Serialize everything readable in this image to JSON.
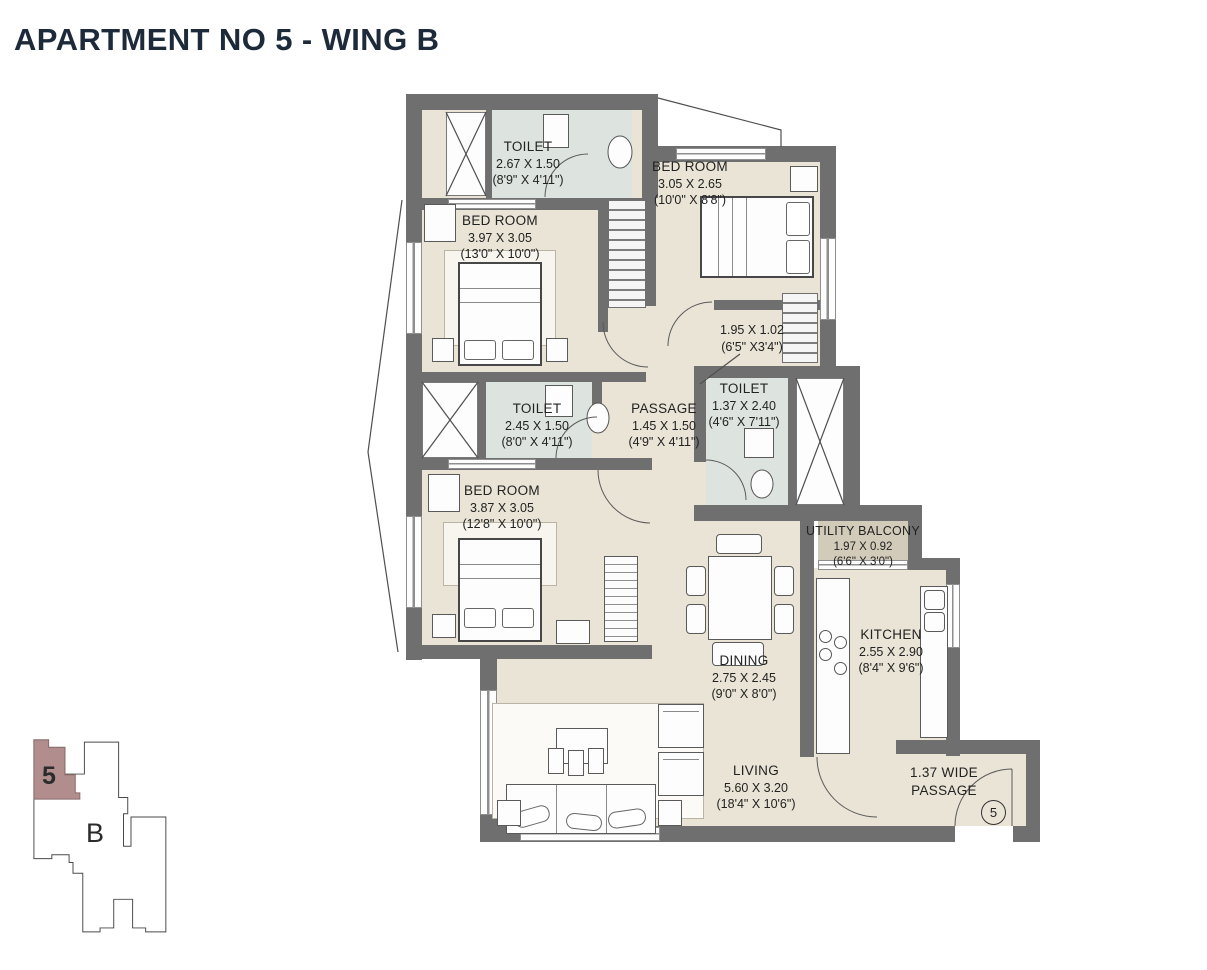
{
  "title": "APARTMENT NO 5 - WING B",
  "rooms": {
    "toilet_top": {
      "name": "TOILET",
      "dim_m": "2.67 X 1.50",
      "dim_ft": "(8'9\" X 4'11\")"
    },
    "bedroom_top_right": {
      "name": "BED ROOM",
      "dim_m": "3.05 X 2.65",
      "dim_ft": "(10'0\" X 8'8\")"
    },
    "bedroom_left": {
      "name": "BED ROOM",
      "dim_m": "3.97 X 3.05",
      "dim_ft": "(13'0\" X 10'0\")"
    },
    "lobby": {
      "dim_m": "1.95 X 1.02",
      "dim_ft": "(6'5\" X3'4\")"
    },
    "passage": {
      "name": "PASSAGE",
      "dim_m": "1.45 X 1.50",
      "dim_ft": "(4'9\" X 4'11\")"
    },
    "toilet_mid": {
      "name": "TOILET",
      "dim_m": "2.45 X 1.50",
      "dim_ft": "(8'0\" X 4'11\")"
    },
    "toilet_right": {
      "name": "TOILET",
      "dim_m": "1.37 X 2.40",
      "dim_ft": "(4'6\" X 7'11\")"
    },
    "bedroom_bottom": {
      "name": "BED ROOM",
      "dim_m": "3.87 X 3.05",
      "dim_ft": "(12'8\" X 10'0\")"
    },
    "utility_balcony": {
      "name": "UTILITY BALCONY",
      "dim_m": "1.97 X 0.92",
      "dim_ft": "(6'6\" X 3'0\")"
    },
    "kitchen": {
      "name": "KITCHEN",
      "dim_m": "2.55 X 2.90",
      "dim_ft": "(8'4\" X 9'6\")"
    },
    "dining": {
      "name": "DINING",
      "dim_m": "2.75 X 2.45",
      "dim_ft": "(9'0\" X 8'0\")"
    },
    "living": {
      "name": "LIVING",
      "dim_m": "5.60 X 3.20",
      "dim_ft": "(18'4\" X 10'6\")"
    },
    "wide_passage": {
      "line1": "1.37 WIDE",
      "line2": "PASSAGE"
    }
  },
  "entry_marker": "5",
  "key_plan": {
    "unit_label": "5",
    "wing_label": "B"
  },
  "colors": {
    "wall": "#6f6f6f",
    "floor": "#e9e4d5",
    "toilet_floor": "#dde4e0",
    "balcony_floor": "#d2cbba",
    "unit_highlight": "#b18d8d",
    "title": "#1c2a3a"
  }
}
